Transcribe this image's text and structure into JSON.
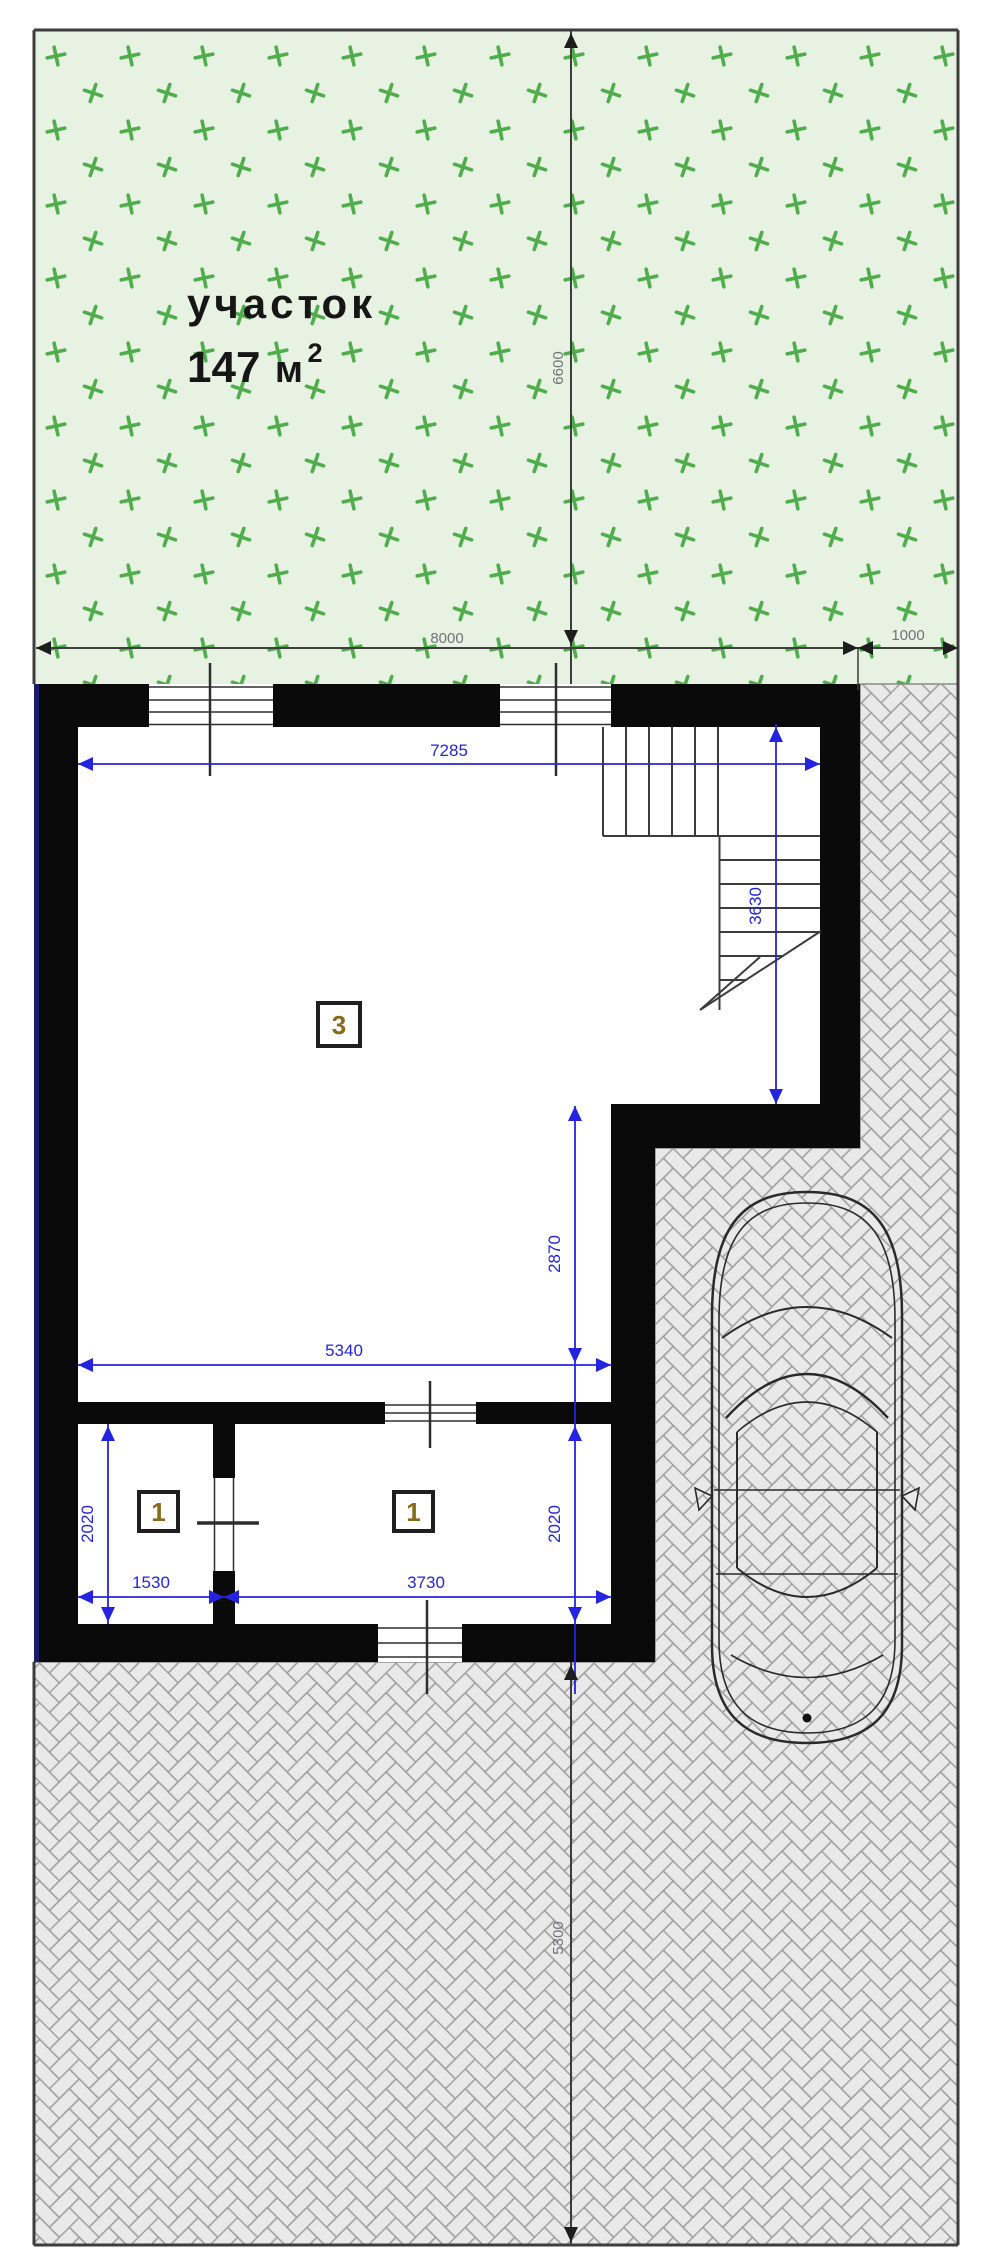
{
  "plot": {
    "label": "участок",
    "area_value": "147",
    "area_unit": "м",
    "area_exponent": "2"
  },
  "rooms": {
    "hall_tag": "3",
    "left_small_tag": "1",
    "right_small_tag": "1"
  },
  "dims": {
    "blue": {
      "top_width": "7285",
      "stairs_depth": "3630",
      "recess_depth": "2870",
      "hall_width": "5340",
      "left_height": "2020",
      "right_height": "2020",
      "small_room_width": "1530",
      "room_width": "3730"
    },
    "gray": {
      "site_width": "8000",
      "side_offset": "1000",
      "lawn_depth": "6600",
      "yard_depth": "5300"
    }
  },
  "colors": {
    "dimension_blue": "#2424e0",
    "dimension_gray": "#6f737c",
    "wall_black": "#0a0a0a",
    "grass_green": "#4fae4b",
    "grass_background": "#e8f2e3",
    "paving_fill": "#e9e9e9",
    "paving_line": "#9c9c9c",
    "boundary_navy": "#1c1c6f",
    "tag_number": "#8a6a1a"
  }
}
